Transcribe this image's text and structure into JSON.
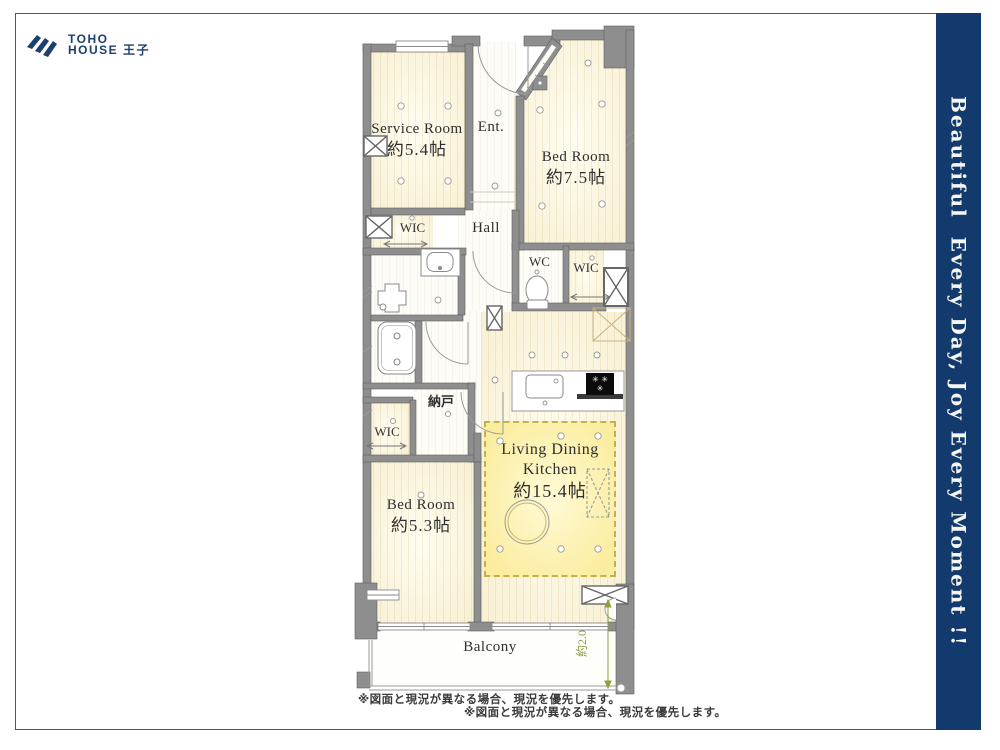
{
  "logo": {
    "line1": "TOHO",
    "line2": "HOUSE 王子"
  },
  "banner": {
    "text": "Beautiful  Every Day, Joy Every Moment !!",
    "bg_color": "#133a6d",
    "text_color": "#f6f6f2"
  },
  "plan": {
    "rooms": {
      "service_room": {
        "name": "Service Room",
        "size": "約5.4帖"
      },
      "entrance": {
        "name": "Ent."
      },
      "bed_room_1": {
        "name": "Bed Room",
        "size": "約7.5帖"
      },
      "wic_upper": {
        "name": "WIC"
      },
      "hall": {
        "name": "Hall"
      },
      "wc": {
        "name": "WC"
      },
      "wic_right": {
        "name": "WIC"
      },
      "storage": {
        "name": "納戸"
      },
      "wic_lower": {
        "name": "WIC"
      },
      "bed_room_2": {
        "name": "Bed Room",
        "size": "約5.3帖"
      },
      "ldk": {
        "name_line1": "Living Dining",
        "name_line2": "Kitchen",
        "size": "約15.4帖"
      },
      "balcony": {
        "name": "Balcony"
      }
    },
    "dimension_label": "約2.0",
    "refrigerator": {
      "symbols_top": "✳ ✳",
      "symbols_bottom": "✳"
    }
  },
  "footer": {
    "disclaimer1": "※図面と現況が異なる場合、現況を優先します。",
    "disclaimer2": "※図面と現況が異なる場合、現況を優先します。"
  },
  "colors": {
    "wall": "#8e8e8e",
    "floor_cream": "#f8f1d6",
    "ldk_highlight": "#fbeda0",
    "accent_navy": "#133a6d"
  }
}
